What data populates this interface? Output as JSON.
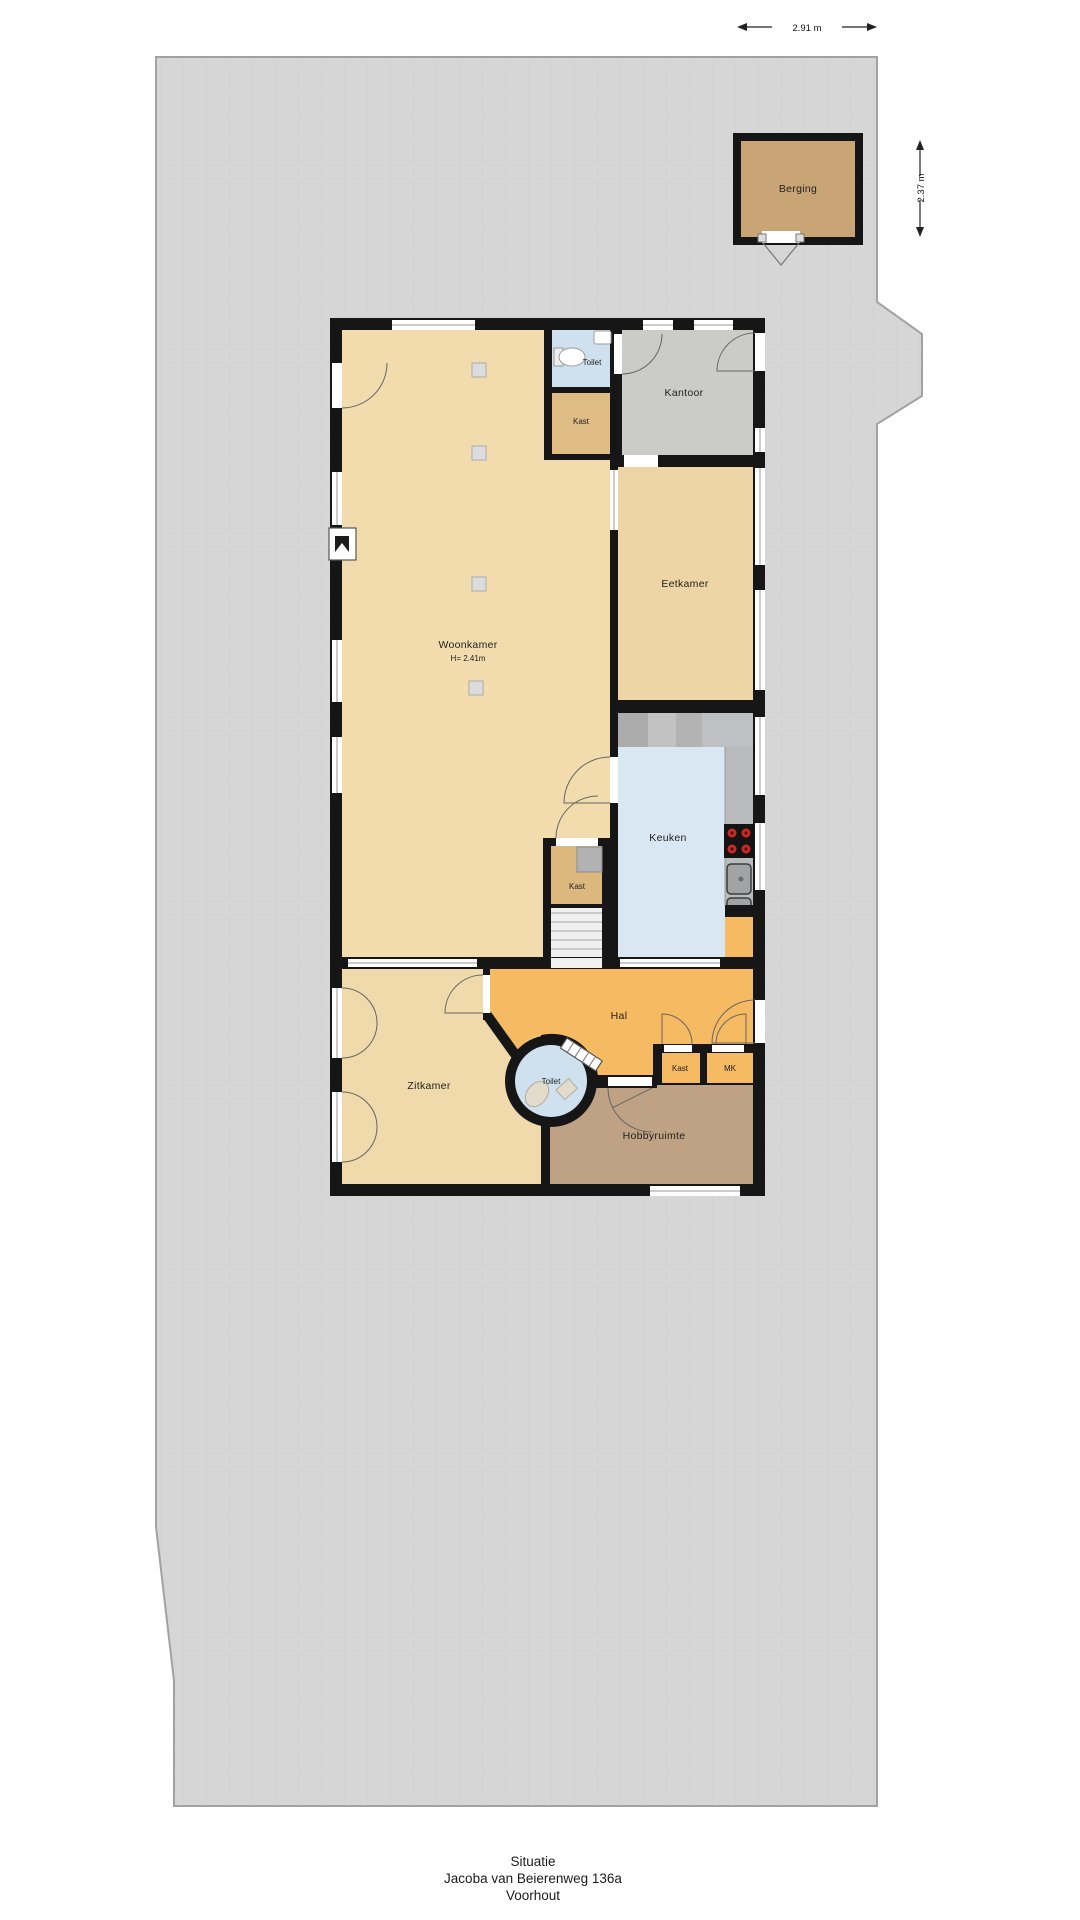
{
  "caption": {
    "line1": "Situatie",
    "line2": "Jacoba van Beierenweg 136a",
    "line3": "Voorhout"
  },
  "dimensions": {
    "top_width": "2.91 m",
    "right_height": "2.37 m"
  },
  "rooms": {
    "berging": "Berging",
    "toilet_top": "Toilet",
    "kast_top": "Kast",
    "kantoor": "Kantoor",
    "woonkamer": "Woonkamer",
    "woonkamer_height": "H= 2.41m",
    "eetkamer": "Eetkamer",
    "keuken": "Keuken",
    "kast_mid": "Kast",
    "hal": "Hal",
    "toilet_round": "Toilet",
    "kast_small": "Kast",
    "mk": "MK",
    "zitkamer": "Zitkamer",
    "hobbyruimte": "Hobbyruimte"
  },
  "colors": {
    "plot": "#d6d6d6",
    "wall": "#161616",
    "living_floor": "#f2dcae",
    "dining_floor": "#eed5a5",
    "closet_floor": "#dfbc84",
    "office_floor": "#cbcbc9",
    "wet_floor": "#cfe1ef",
    "kitchen_floor": "#d9e7f3",
    "hall_floor": "#f6ba62",
    "hobby_floor": "#bfa284",
    "shed_floor": "#c9a576",
    "counter": "#b9babc",
    "burner": "#cc2a22"
  }
}
